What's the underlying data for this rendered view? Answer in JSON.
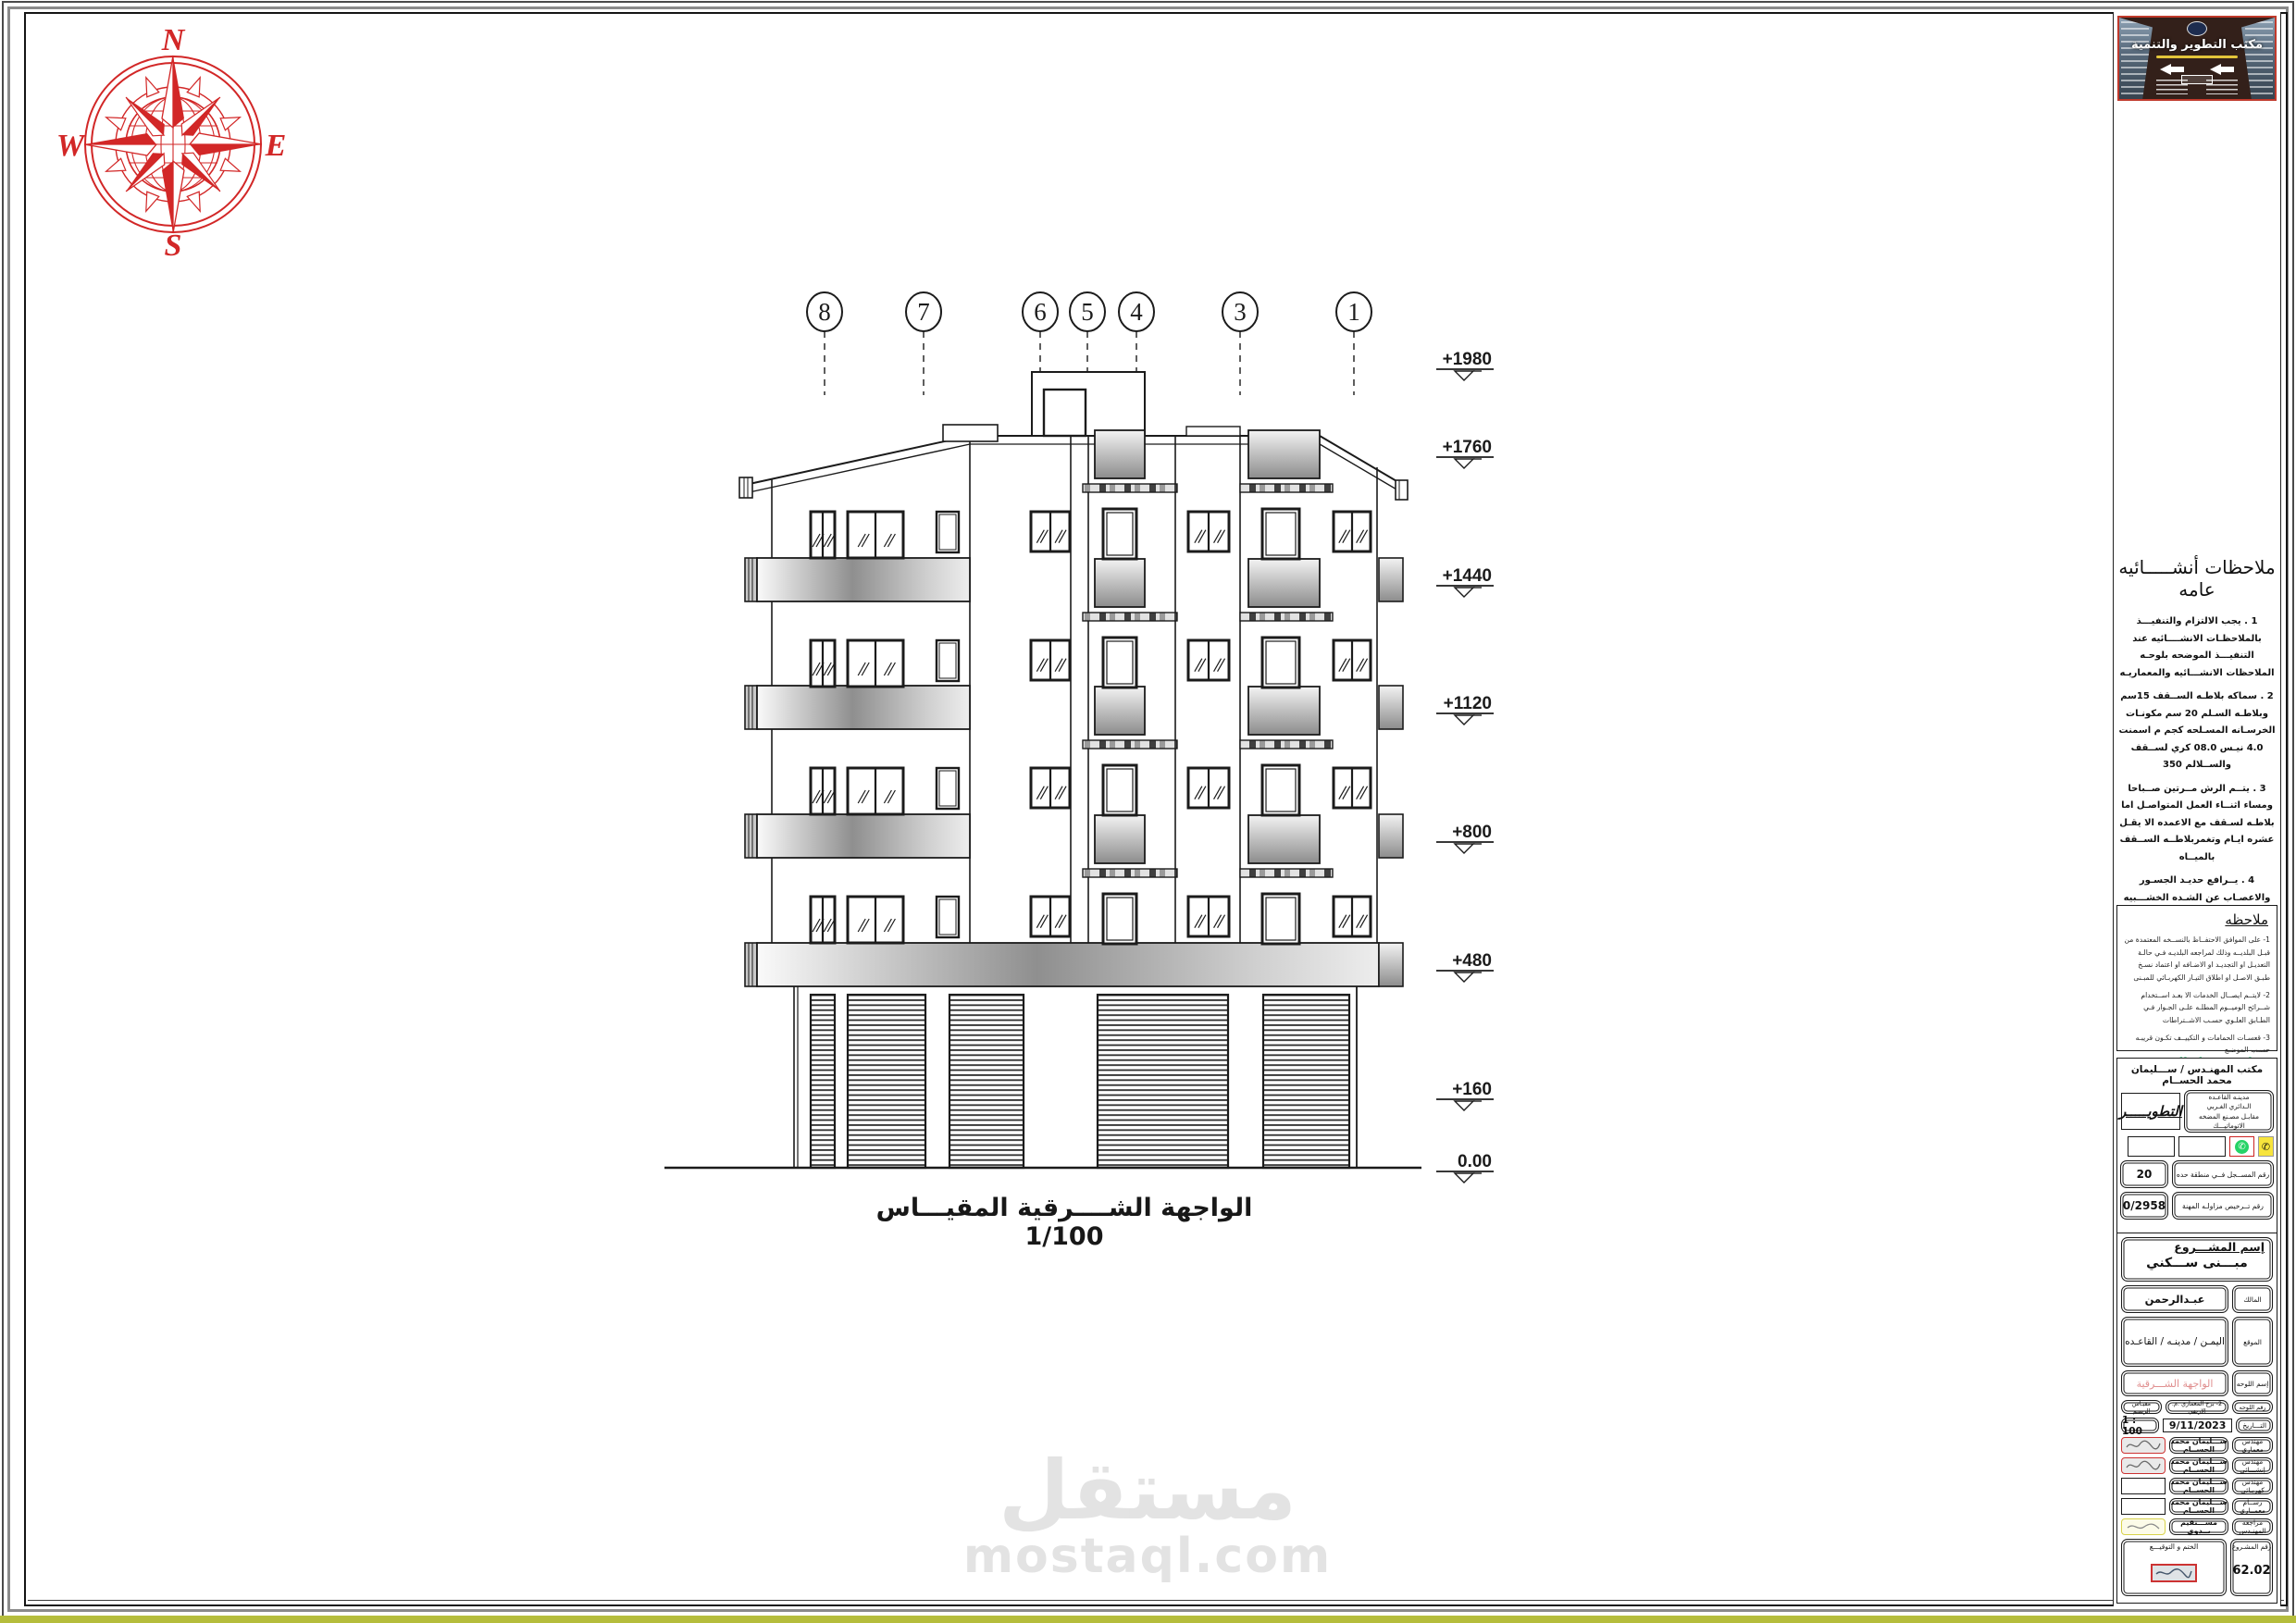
{
  "drawing": {
    "grid_bubbles": [
      "8",
      "7",
      "6",
      "5",
      "4",
      "3",
      "1"
    ],
    "elevations": [
      "+1980",
      "+1760",
      "+1440",
      "+1120",
      "+800",
      "+480",
      "+160",
      "0.00"
    ],
    "caption": "الواجهة الشــــرقية  المقيـــاس 1/100",
    "compass": {
      "north": "N",
      "east": "E",
      "south": "S",
      "west": "W"
    }
  },
  "watermark": {
    "title": "مستقل",
    "domain": "mostaql.com"
  },
  "panel": {
    "banner": {
      "title": "مكتب التطوير والتنمية"
    },
    "general_notes": {
      "title": "ملاحظات أنشـــــائيه عامه",
      "items": [
        "1 . يجب الالتزام والتنفيـــذ بالملاحظـات الانشــــائيه عند التنفيـــذ الموضحه بلوحـه الملاحظات الانشـــائيه والمعماريـه",
        "2 . سماكه بلاطـه الســقف 15سم وبلاطـه السـلم 20 سم مكونـات الخرسـانه المسـلحه كجم م اسمنت 4.0 نيـس 08.0 كري لســقف والســلالم 350",
        "3 . يتــم الرش مــرتين صــباحا ومساء اثنــاء العمل المتواصـل اما بلاطـه لسـقف مع الاعمده الا يقـل عشره ايـام وتغمربلاطــه الســقف بالميــاه",
        "4 . يــرافع حديـد الجسـور والاعصـاب عن الشـده الخشـــبيه بمقـدر 2.2سم",
        "5 . يجـب تكليــش حديد الجســور والبلاطـات والاعمده فــي جميع الاطراف . .",
        "6 ,اشـــاير حديد الاعمده فـوق الصبـه الخرسـانيه يجـب الاقـل 55سم قطر الســيخ"
      ],
      "highlight": "7.لا يتحمــل المهنـدس المصـــمم ناتجـه عن سـوء التنفيــــذ مالم يكـون هوالمشـراف علـى التنفيــــذ",
      "highlight_color": "#00a651"
    },
    "remark_box": {
      "title": "ملاحظه",
      "items": [
        "1- على الموافق الاحتفــاظ بالنســخه المعتمدة من قبـل البلديــه وذلك لمراجعه البلديـه فـي حالـة التعديـل او التجديـد او الاضـافه او اعتماد نسـخ طبـق الاصـل او اطلاق التيـار الكهربـائي للمبـنى",
        "2- لايتــم ايصــال الخدمات الا بعـد اســتخدام شــرائح الوميــوم المطلـه علـى الجـوار فـي الطـابق العلـوي حسـب الاشــتراطات",
        "3- قعسـات الحمامات و التكييــف تكـون قريبـه حسـب الموضـع"
      ]
    },
    "office": {
      "header": "مكتب المهنـدس /  ســـليمان محمد الحســام",
      "logo_text": "التطويـــــر",
      "address_lines": [
        "مدينـه القاعـده",
        "الـدائري الغـربي",
        "مقابـل مصـنع المضخه",
        "الاتوماتيـــك"
      ],
      "registration": {
        "label": "رقم المســجل فــي منطقة حده",
        "value": "20"
      },
      "license": {
        "label": "رقم تــرخيص مزاولـه المهنة",
        "value": "0/2958"
      }
    },
    "titleblock": {
      "project_label": "إسم المشـــروع",
      "project_name": "مبـــنى ســـكني",
      "owner": {
        "label": "المالك",
        "value": "عبـدالرحمن"
      },
      "location": {
        "label": "الموقع",
        "value": "اليمـن / مدينـه / القاعـده"
      },
      "sheet_name": {
        "label": "إسم اللوحه",
        "value": "الواجهة الشـــرقية"
      },
      "sheet_no": {
        "label": "رقم اللوحه",
        "value": "2- برج المعماري .م. الارضي",
        "scale_label": "مقيـاس الرسـم"
      },
      "date": {
        "label": "التـــاريخ",
        "value": "9/11/2023",
        "scale_value": "1 : 100"
      },
      "signatories": [
        {
          "label": "مهندس معماري",
          "value": "ســـليمان محمد الحســام"
        },
        {
          "label": "مهندس إنشـــائي",
          "value": "ســـليمان محمد الحســام"
        },
        {
          "label": "مهندس كهربـائي",
          "value": "ســـليمان محمد الحســام"
        },
        {
          "label": "رســام معمــاري",
          "value": "ســـليمان محمد الحســام"
        },
        {
          "label": "مراجعه المهنـدس",
          "value": "مســـتقيم بــدوي"
        }
      ],
      "stamp_label": "الختم و التوقيـــع",
      "project_no": {
        "label": "رقم المشـروع",
        "value": "62.02"
      }
    }
  }
}
